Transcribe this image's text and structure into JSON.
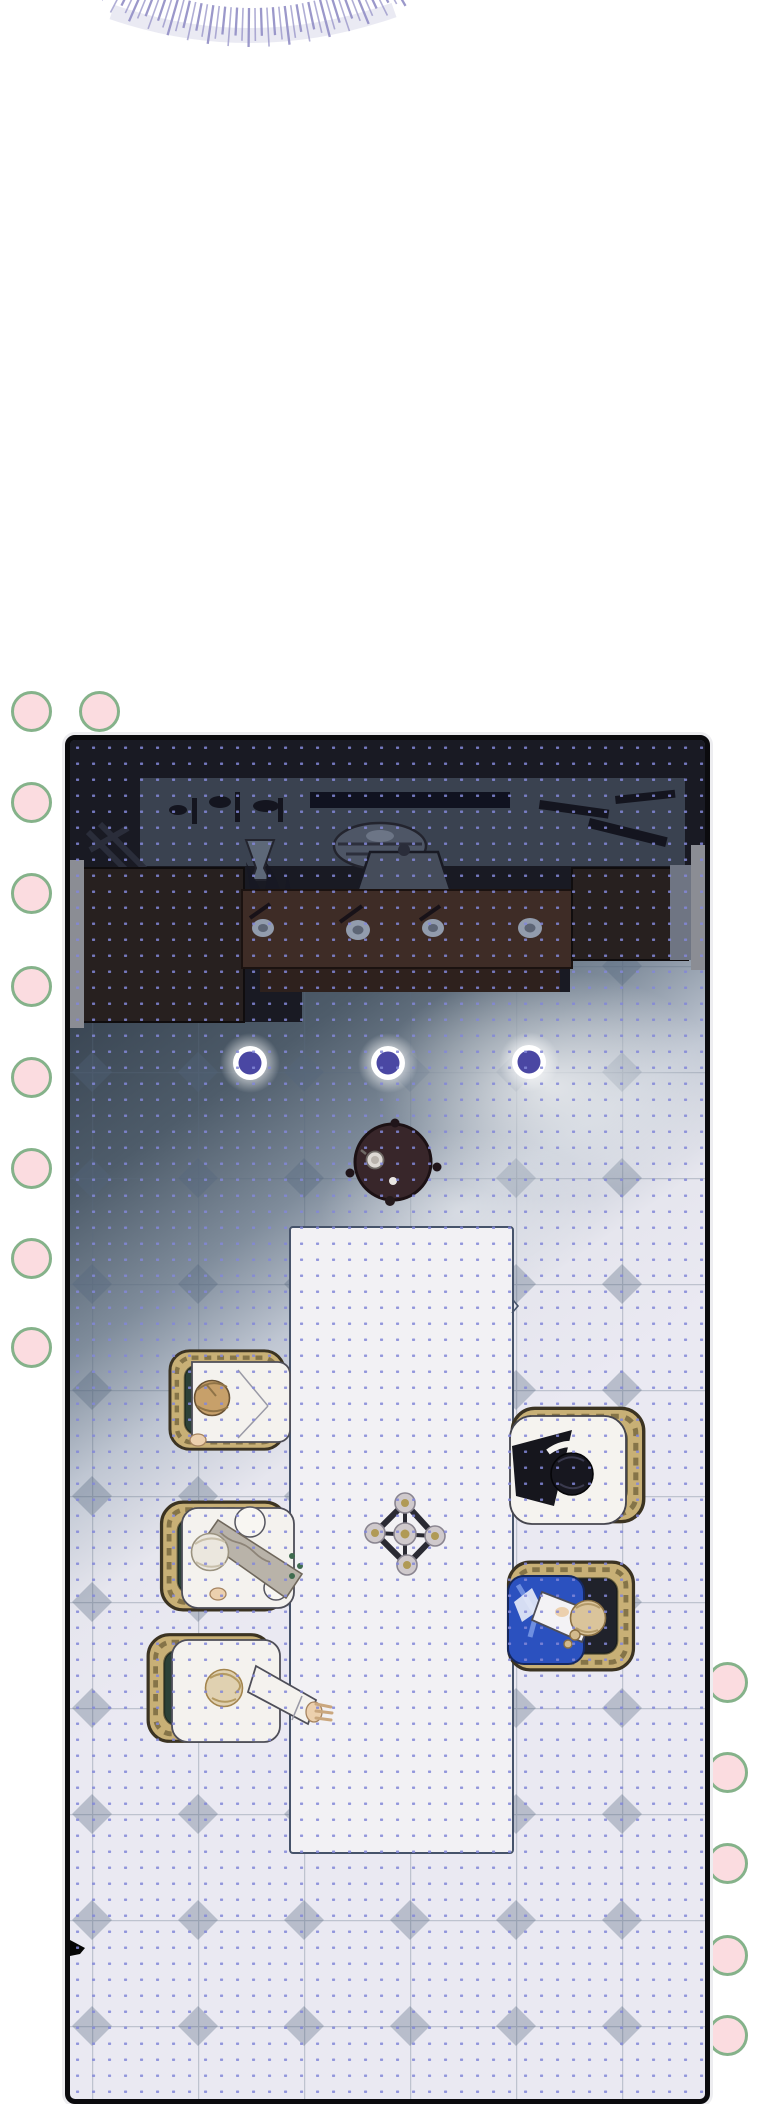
{
  "meta": {
    "kind": "webtoon-comic-panel",
    "description": "Vertical webtoon strip: top-of-image radial speedline burst, decorative pink circles along left and right margins, and one large comic panel showing a top-down view of a dim dining hall. Dark furniture lines the top wall, three glowing ceiling lights shine over a tiled floor lit diagonally from the lower right, a small round side table sits above a long white dining table with a five-candle centerpiece, three white-robed figures sit on the left side and two figures (one black-haired, one in a blue robe) sit on the right, all in gold-framed chairs. A halftone dot screen covers the whole panel."
  },
  "palette": {
    "page_bg": "#ffffff",
    "pink_dot_fill": "#fbdce0",
    "pink_dot_stroke": "#85b28a",
    "burst_ray": "#9693c8",
    "burst_haze": "#b5b3d4",
    "panel_border": "#0b0b0e",
    "halftone_dot": "#8287d8",
    "room_dark": "#191a23",
    "shelf_band": "#3a4250",
    "wood_dark": "#27201f",
    "wood_mid": "#3e2c26",
    "door_frame": "#8b8d94",
    "light_ring": "#ffffff",
    "light_core": "#4a47a3",
    "round_table": "#38262a",
    "round_table_edge": "#1c1114",
    "long_table": "#f2f1f4",
    "table_outline": "#46536a",
    "chair_frame": "#c8b076",
    "chair_frame_edge": "#3b3322",
    "chair_stud": "#857448",
    "cushion_green": "#2c4137",
    "cushion_dark_green": "#26332c",
    "cushion_black": "#20222b",
    "robe_white": "#f4f2ee",
    "robe_outline": "#4e4e58",
    "robe_blue": "#2b51bf",
    "robe_blue_edge": "#16285f",
    "sash_gray": "#b9b3a9",
    "hair_blond": "#c7a06a",
    "hair_silver": "#ebe7de",
    "hair_pale_blond": "#e0d1b1",
    "hair_black": "#17171f",
    "hair_sandy": "#dac49b",
    "skin": "#ecd0ae",
    "candle_cup": "#cfc9cc",
    "candle_flame": "#b09a55"
  },
  "burst": {
    "cx": 150,
    "cy": -260,
    "inner_radius": 268,
    "outer_long": 307,
    "outer_short": 296,
    "ray_count": 48,
    "angle_start": 60,
    "angle_end": 120
  },
  "decorative_dots": {
    "radius": 19,
    "border_width": 3,
    "left": [
      [
        31,
        711
      ],
      [
        99,
        711
      ],
      [
        31,
        802
      ],
      [
        31,
        893
      ],
      [
        31,
        986
      ],
      [
        31,
        1077
      ],
      [
        31,
        1168
      ],
      [
        31,
        1258
      ],
      [
        31,
        1347
      ]
    ],
    "right": [
      [
        727,
        1682
      ],
      [
        727,
        1772
      ],
      [
        727,
        1863
      ],
      [
        727,
        1955
      ],
      [
        727,
        2035
      ]
    ]
  },
  "panel": {
    "x": 65,
    "y": 735,
    "width": 635,
    "height": 1359,
    "lights": [
      [
        180,
        323
      ],
      [
        318,
        323
      ],
      [
        459,
        322
      ]
    ],
    "light_outer_radius": 17,
    "light_core_radius": 11.5,
    "round_table": {
      "cx": 323,
      "cy": 422,
      "radius": 38
    },
    "long_table": {
      "x": 220,
      "y": 487,
      "width": 223,
      "height": 626
    },
    "centerpiece": {
      "cx": 335,
      "cy": 793,
      "candles": 5
    },
    "people": [
      {
        "id": "person-blond",
        "side": "left",
        "hair": "blond"
      },
      {
        "id": "person-silver",
        "side": "left",
        "hair": "silver-white"
      },
      {
        "id": "person-pale-blond",
        "side": "left",
        "hair": "pale-blond",
        "pose": "arm-on-table"
      },
      {
        "id": "person-black-hair",
        "side": "right",
        "hair": "black"
      },
      {
        "id": "person-blue-robe",
        "side": "right",
        "hair": "sandy-braid",
        "clothes": "blue"
      }
    ]
  }
}
